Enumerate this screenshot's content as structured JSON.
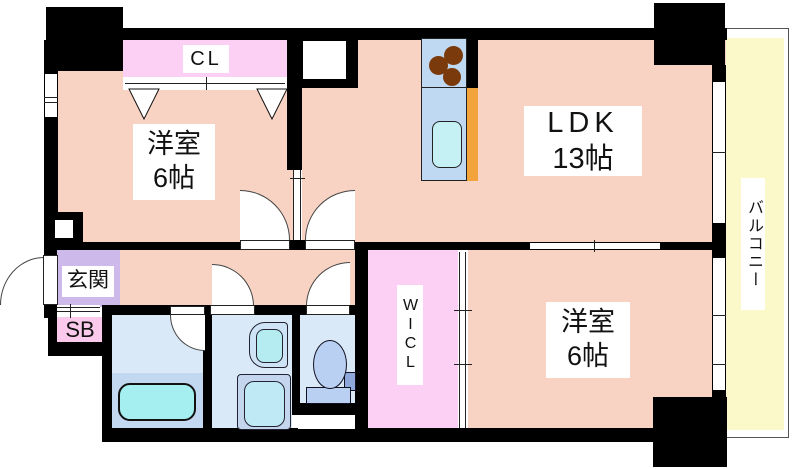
{
  "floorplan": {
    "labels": {
      "cl": "CL",
      "bedroom1_name": "洋室",
      "bedroom1_size": "6帖",
      "ldk_name": "LDK",
      "ldk_size": "13帖",
      "bedroom2_name": "洋室",
      "bedroom2_size": "6帖",
      "genkan": "玄関",
      "shoebox": "SB",
      "wicl": "WICL",
      "balcony": "バルコニー"
    },
    "colors": {
      "wall": "#000000",
      "room_salmon": "#F8D3C3",
      "closet_pink": "#FBD0F4",
      "genkan_purple": "#CDBAEB",
      "shoebox_pink": "#FBC9EC",
      "balcony_yellow": "#FBF8C9",
      "sanitary_blue": "#D9E9F7",
      "bathtub_cyan": "#A5EFF0",
      "fixture_blue": "#B9D0F2",
      "kitchen_counter_blue": "#BFD9F3",
      "kitchen_orange": "#F2A33C",
      "burner_brown": "#7B3A0B"
    }
  }
}
